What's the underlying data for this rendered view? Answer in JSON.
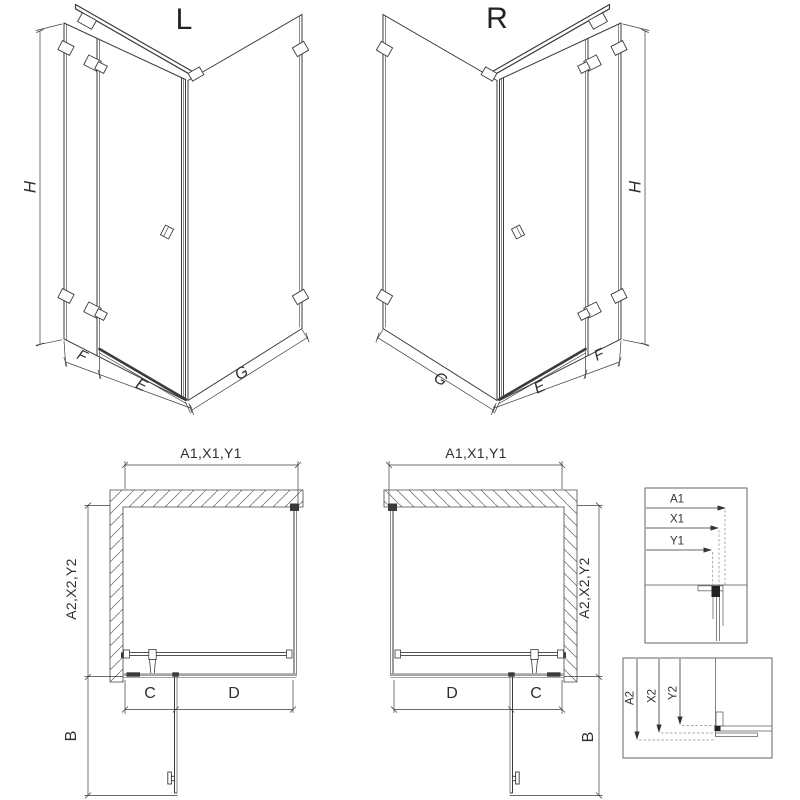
{
  "drawing_type": "shower-enclosure-technical-drawing",
  "views": {
    "iso_left": {
      "label": "L",
      "dims": {
        "h": "H",
        "f": "F",
        "e": "E",
        "g": "G"
      }
    },
    "iso_right": {
      "label": "R",
      "dims": {
        "h": "H",
        "f": "F",
        "e": "E",
        "g": "G"
      }
    },
    "plan_left": {
      "dims": {
        "width": "A1,X1,Y1",
        "depth": "A2,X2,Y2",
        "c": "C",
        "d": "D",
        "b": "B"
      }
    },
    "plan_right": {
      "dims": {
        "width": "A1,X1,Y1",
        "depth": "A2,X2,Y2",
        "c": "C",
        "d": "D",
        "b": "B"
      }
    },
    "detail_width": {
      "a1": "A1",
      "x1": "X1",
      "y1": "Y1"
    },
    "detail_depth": {
      "a2": "A2",
      "x2": "X2",
      "y2": "Y2"
    }
  },
  "colors": {
    "line": "#3b3b3b",
    "dimension": "#3b3b3b",
    "tray_gray": "#a6a6a6",
    "hatch": "#787878",
    "detail_box_border": "#555555",
    "background": "#ffffff"
  }
}
